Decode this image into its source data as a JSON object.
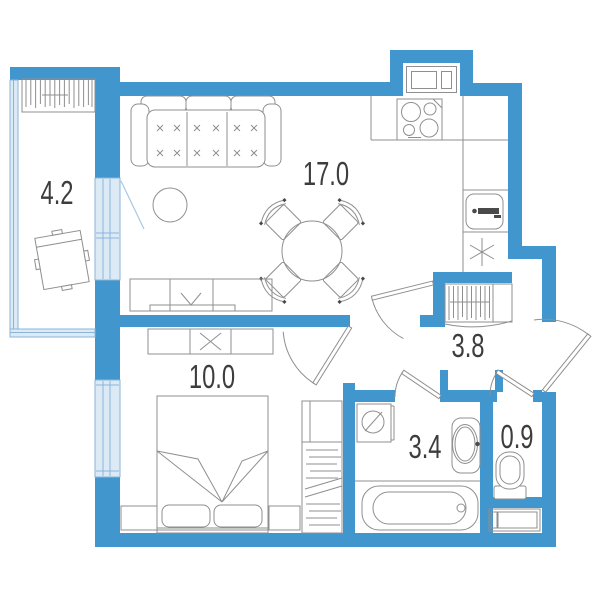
{
  "rooms": {
    "balcony": {
      "area": "4.2",
      "fixtures": [
        "storage-rack",
        "chair"
      ]
    },
    "living_kitchen": {
      "area": "17.0",
      "fixtures": [
        "sofa",
        "side-table",
        "dining-table",
        "four-chairs",
        "tv-stand",
        "kitchen-counter",
        "cooktop",
        "kitchen-sink",
        "fridge-spot-asterisk",
        "vent-window"
      ]
    },
    "bedroom": {
      "area": "10.0",
      "fixtures": [
        "double-bed",
        "pillows",
        "nightstand-left",
        "nightstand-right",
        "low-wardrobe",
        "closet-with-hangers"
      ]
    },
    "hallway": {
      "area": "3.8",
      "fixtures": [
        "coat-rack",
        "entrance-door"
      ]
    },
    "bathroom": {
      "area": "3.4",
      "fixtures": [
        "washing-machine",
        "wash-basin",
        "bathtub"
      ]
    },
    "wc": {
      "area": "0.9",
      "fixtures": [
        "toilet",
        "cabinet"
      ]
    }
  },
  "colors": {
    "wall": "#4096cd",
    "glazing_fill": "#dceaf6",
    "glazing_stroke": "#8ab5d9",
    "swing_line": "#a5c9e5",
    "furniture_line": "#8f8f8f",
    "label_text": "#3d3d3d",
    "fixture_dark": "#4a4a4a"
  }
}
